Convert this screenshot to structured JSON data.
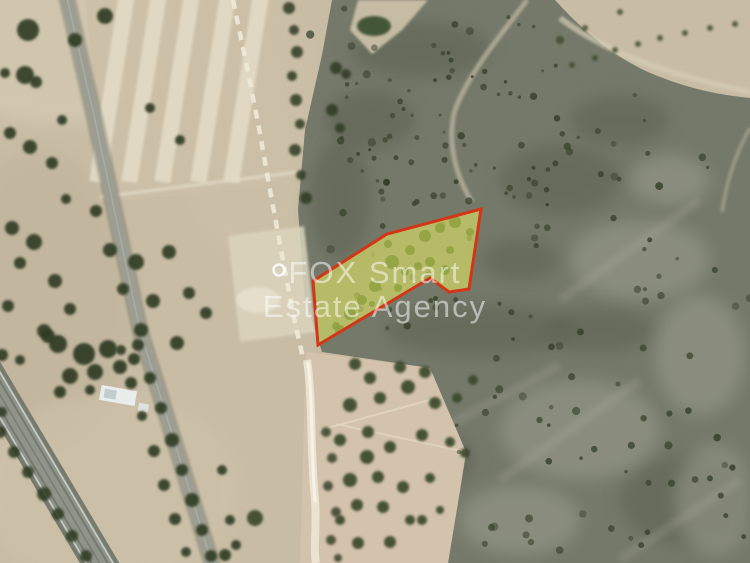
{
  "map": {
    "type": "satellite-aerial-photo",
    "subject": "highlighted-land-plot"
  },
  "watermark": {
    "line1": "FOX Smart",
    "line2": "Estate Agency",
    "color": "#ffffff",
    "opacity": 0.52
  },
  "plot": {
    "points": "481,209 469,289 449,292 430,278 318,345 313,281 387,234",
    "fill": "#dfe365",
    "fill_opacity": 0.62,
    "stroke": "#d43517",
    "stroke_width": 3
  },
  "palette": {
    "field_beige": "#c8bca5",
    "field_light": "#e8e1cd",
    "bright_patch": "#dbd4bd",
    "scrub_green_gray": "#75796a",
    "scrub_dark": "#5a5f50",
    "scrub_light": "#9fa190",
    "tree_dark_green": "#2e3b22",
    "olive_tree": "#3a4a2b",
    "road_gray": "#9c9e94",
    "highway_gray": "#8f948a",
    "track_white": "#eee9d8",
    "grove_beige": "#d3c2ac",
    "building_white": "#e9edec"
  }
}
